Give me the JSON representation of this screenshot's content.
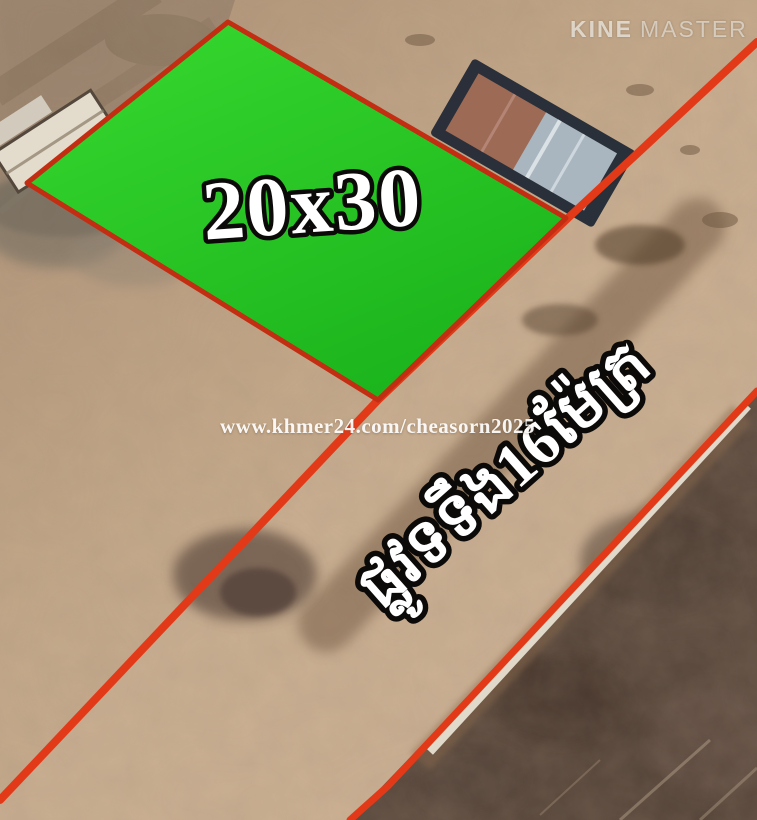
{
  "watermarks": {
    "kine": "KINE",
    "master": "MASTER",
    "khmer24": "www.khmer24.com/cheasorn2025"
  },
  "plot": {
    "size_label": "20x30",
    "fill_color_light": "#38d92f",
    "fill_color_dark": "#1cb51d",
    "border_color": "#c32d12"
  },
  "road": {
    "label": "ផ្លូវទទឹង16ម៉ែត្រ",
    "line_color": "#e23a18"
  }
}
